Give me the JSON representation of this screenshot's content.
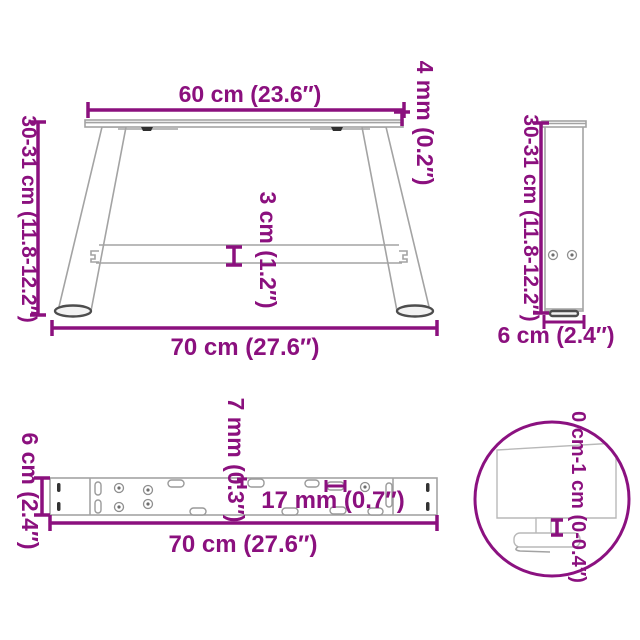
{
  "colors": {
    "dimension_magenta": "#8B107E",
    "drawing_gray": "#a3a3a3",
    "background": "#ffffff"
  },
  "front_view": {
    "top_width": "60 cm (23.6″)",
    "plate_thickness": "4 mm (0.2″)",
    "height": "30-31 cm (11.8-12.2″)",
    "crossbar_height": "3 cm (1.2″)",
    "bottom_width": "70 cm (27.6″)"
  },
  "side_view": {
    "height": "30-31 cm (11.8-12.2″)",
    "depth": "6 cm (2.4″)"
  },
  "top_view": {
    "depth": "6 cm (2.4″)",
    "slot_height": "7 mm (0.3″)",
    "slot_width": "17 mm (0.7″)",
    "length": "70 cm (27.6″)"
  },
  "detail_view": {
    "adjustable_range": "0 cm-1 cm (0-0.4″)"
  }
}
